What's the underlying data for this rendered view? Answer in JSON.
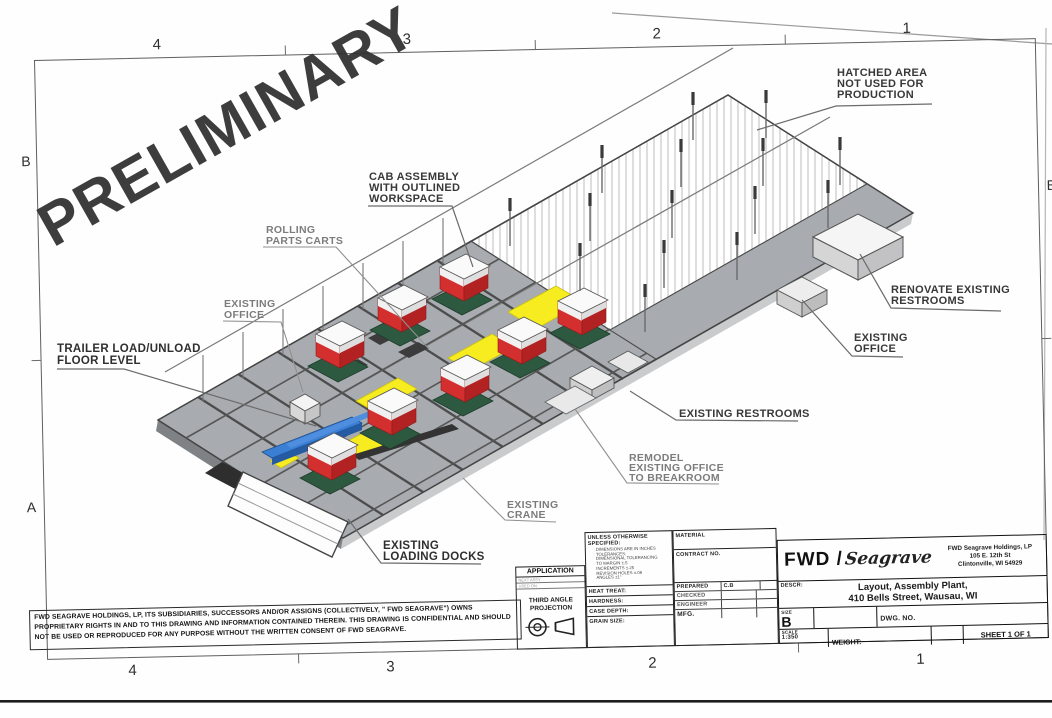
{
  "sheet": {
    "watermark": "PRELIMINARY",
    "zones_top": [
      "4",
      "3",
      "2",
      "1"
    ],
    "zones_bottom": [
      "4",
      "3",
      "2",
      "1"
    ],
    "letters_left": [
      "B",
      "A"
    ],
    "letters_right": [
      "B",
      "A"
    ]
  },
  "annotations": {
    "hatched_area": {
      "lines": [
        "HATCHED AREA",
        "NOT USED FOR",
        "PRODUCTION"
      ]
    },
    "cab_assembly": {
      "lines": [
        "CAB ASSEMBLY",
        "WITH OUTLINED",
        "WORKSPACE"
      ]
    },
    "rolling_carts": {
      "lines": [
        "ROLLING",
        "PARTS CARTS"
      ]
    },
    "existing_office_left": {
      "lines": [
        "EXISTING",
        "OFFICE"
      ]
    },
    "trailer_load": {
      "lines": [
        "TRAILER LOAD/UNLOAD",
        "FLOOR LEVEL"
      ]
    },
    "renovate_restrooms": {
      "lines": [
        "RENOVATE EXISTING",
        "RESTROOMS"
      ]
    },
    "existing_office_right": {
      "lines": [
        "EXISTING",
        "OFFICE"
      ]
    },
    "existing_restrooms": {
      "lines": [
        "EXISTING RESTROOMS"
      ]
    },
    "remodel_office": {
      "lines": [
        "REMODEL",
        "EXISTING OFFICE",
        "TO BREAKROOM"
      ]
    },
    "existing_crane": {
      "lines": [
        "EXISTING",
        "CRANE"
      ]
    },
    "loading_docks": {
      "lines": [
        "EXISTING",
        "LOADING DOCKS"
      ]
    }
  },
  "disclaimer": {
    "text": "FWD SEAGRAVE HOLDINGS, LP, ITS SUBSIDIARIES, SUCCESSORS AND/OR ASSIGNS (COLLECTIVELY, \" FWD SEAGRAVE\") OWNS PROPRIETARY RIGHTS IN AND TO THIS DRAWING AND INFORMATION CONTAINED THEREIN. THIS DRAWING IS CONFIDENTIAL AND SHOULD NOT BE USED OR REPRODUCED FOR ANY PURPOSE WITHOUT THE WRITTEN CONSENT OF FWD SEAGRAVE."
  },
  "title_block": {
    "application": {
      "header": "APPLICATION",
      "rows": [
        "NEXT ASSY",
        "USED ON"
      ]
    },
    "projection": {
      "line1": "THIRD ANGLE",
      "line2": "PROJECTION"
    },
    "unless_header": "UNLESS OTHERWISE SPECIFIED:",
    "tolerance_lines": [
      "DIMENSIONS ARE IN INCHES",
      "TOLERANCES:",
      "DIMENSIONAL TOLERANCING",
      "TO MARGIN ±.5",
      "INCREMENTS ±.25",
      "REVISION HOLES ±.06",
      "ANGLES ±1°"
    ],
    "material_label": "MATERIAL",
    "contract_label": "CONTRACT NO.",
    "left_rows": [
      "HEAT TREAT:",
      "HARDNESS:",
      "CASE DEPTH:",
      "GRAIN SIZE:"
    ],
    "sign_rows": [
      {
        "label": "PREPARED",
        "value": "C.B"
      },
      {
        "label": "CHECKED",
        "value": ""
      },
      {
        "label": "ENGINEER",
        "value": ""
      },
      {
        "label": "MFG.",
        "value": ""
      }
    ],
    "logo": {
      "fwd": "FWD /",
      "seagrave": "Seagrave"
    },
    "company_line1": "FWD Seagrave Holdings, LP",
    "company_line2": "105 E. 12th St",
    "company_line3": "Clintonville, WI 54929",
    "descr_label": "DESCR:",
    "descr_line1": "Layout, Assembly Plant,",
    "descr_line2": "410 Bells Street, Wausau, WI",
    "size_label": "SIZE",
    "size_value": "B",
    "dwg_label": "DWG. NO.",
    "scale_label": "SCALE",
    "scale_value": "1:350",
    "weight_label": "WEIGHT:",
    "sheet_label": "SHEET 1 OF 1"
  },
  "colors": {
    "floor_gray": "#a8acb0",
    "beam_dark": "#4c4c4c",
    "machine_red": "#d32f2f",
    "machine_top_white": "#fafafa",
    "base_green": "#2d5941",
    "workspace_yellow": "#f6ec20",
    "conveyor_blue": "#3b7fd4",
    "dock_white": "#fdfdfd",
    "hatch_line": "#b5b5b5"
  }
}
